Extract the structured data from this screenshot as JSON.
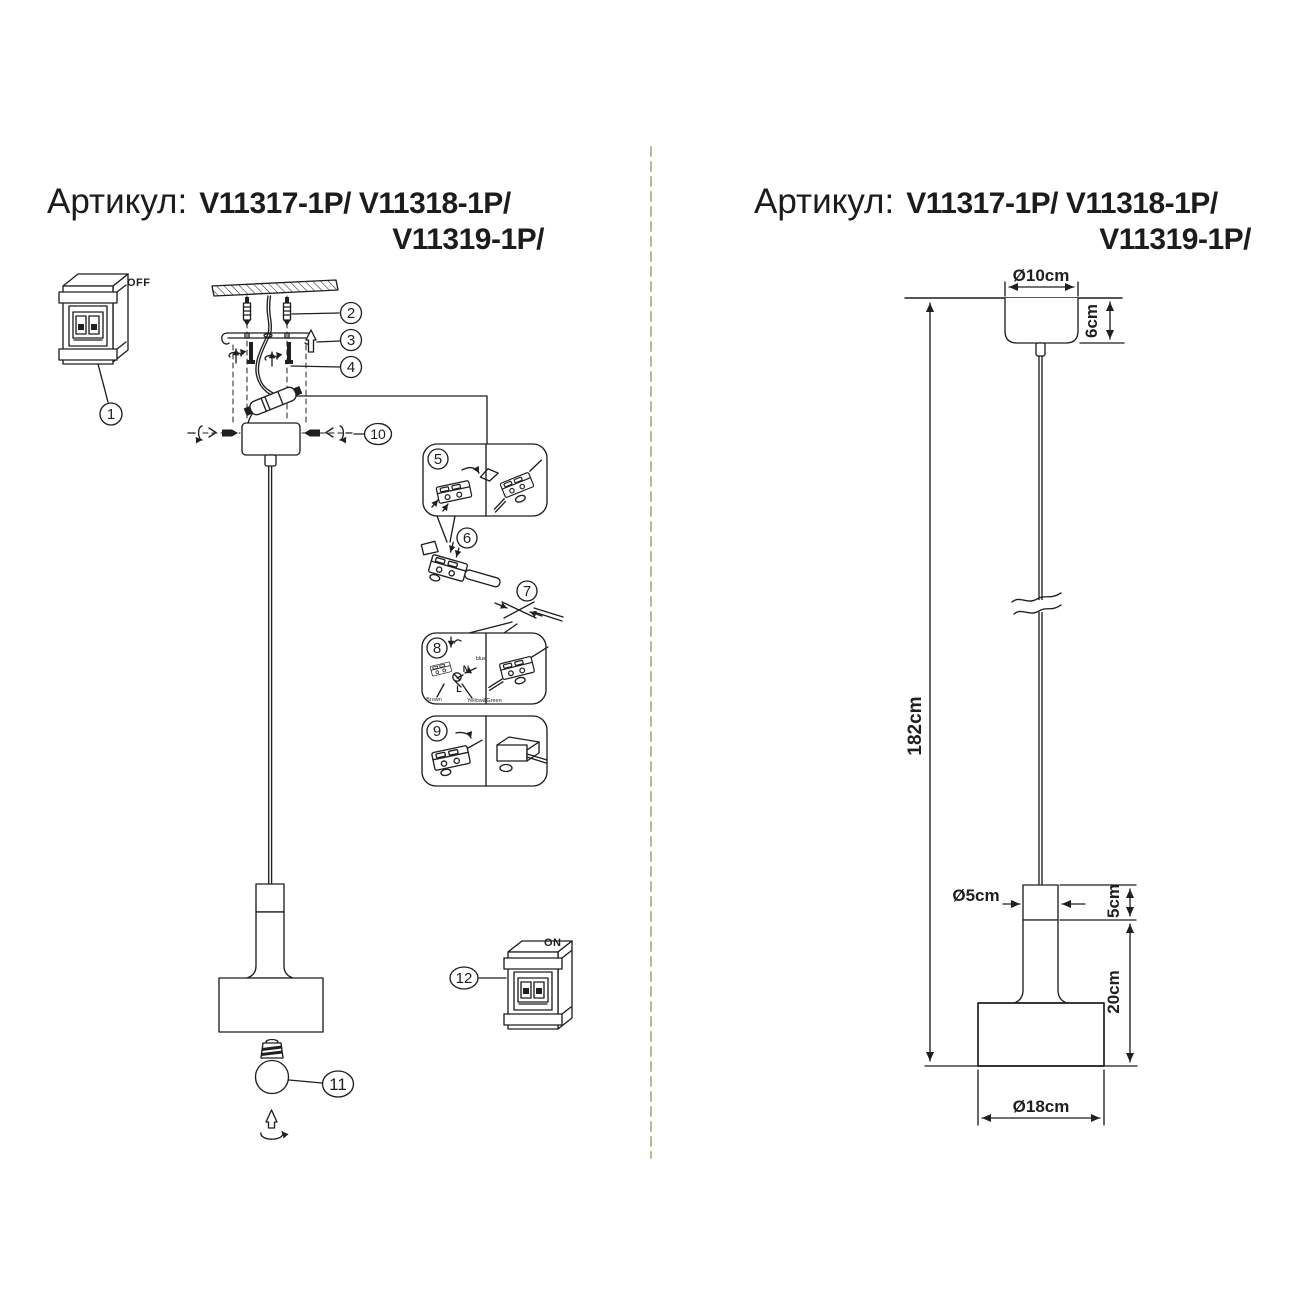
{
  "page": {
    "background": "#ffffff",
    "ink_color": "#1f1f1f",
    "divider_color": "#b8b892"
  },
  "title": {
    "label": "Артикул:",
    "codes_line1": "V11317-1P/ V11318-1P/",
    "codes_line2": "V11319-1P/"
  },
  "left": {
    "steps": [
      "1",
      "2",
      "3",
      "4",
      "5",
      "6",
      "7",
      "8",
      "9",
      "10",
      "11",
      "12"
    ],
    "switch_off_label": "OFF",
    "switch_on_label": "ON",
    "wiring": {
      "neutral": "N",
      "live": "L",
      "blue": "blue",
      "brown": "Brown",
      "ground": "Yellow&Green"
    }
  },
  "right": {
    "dims": {
      "canopy_diameter": "Ø10cm",
      "canopy_height": "6cm",
      "overall_drop": "182cm",
      "cap_diameter": "Ø5cm",
      "cap_height": "5cm",
      "body_height": "20cm",
      "shade_diameter": "Ø18cm"
    }
  }
}
